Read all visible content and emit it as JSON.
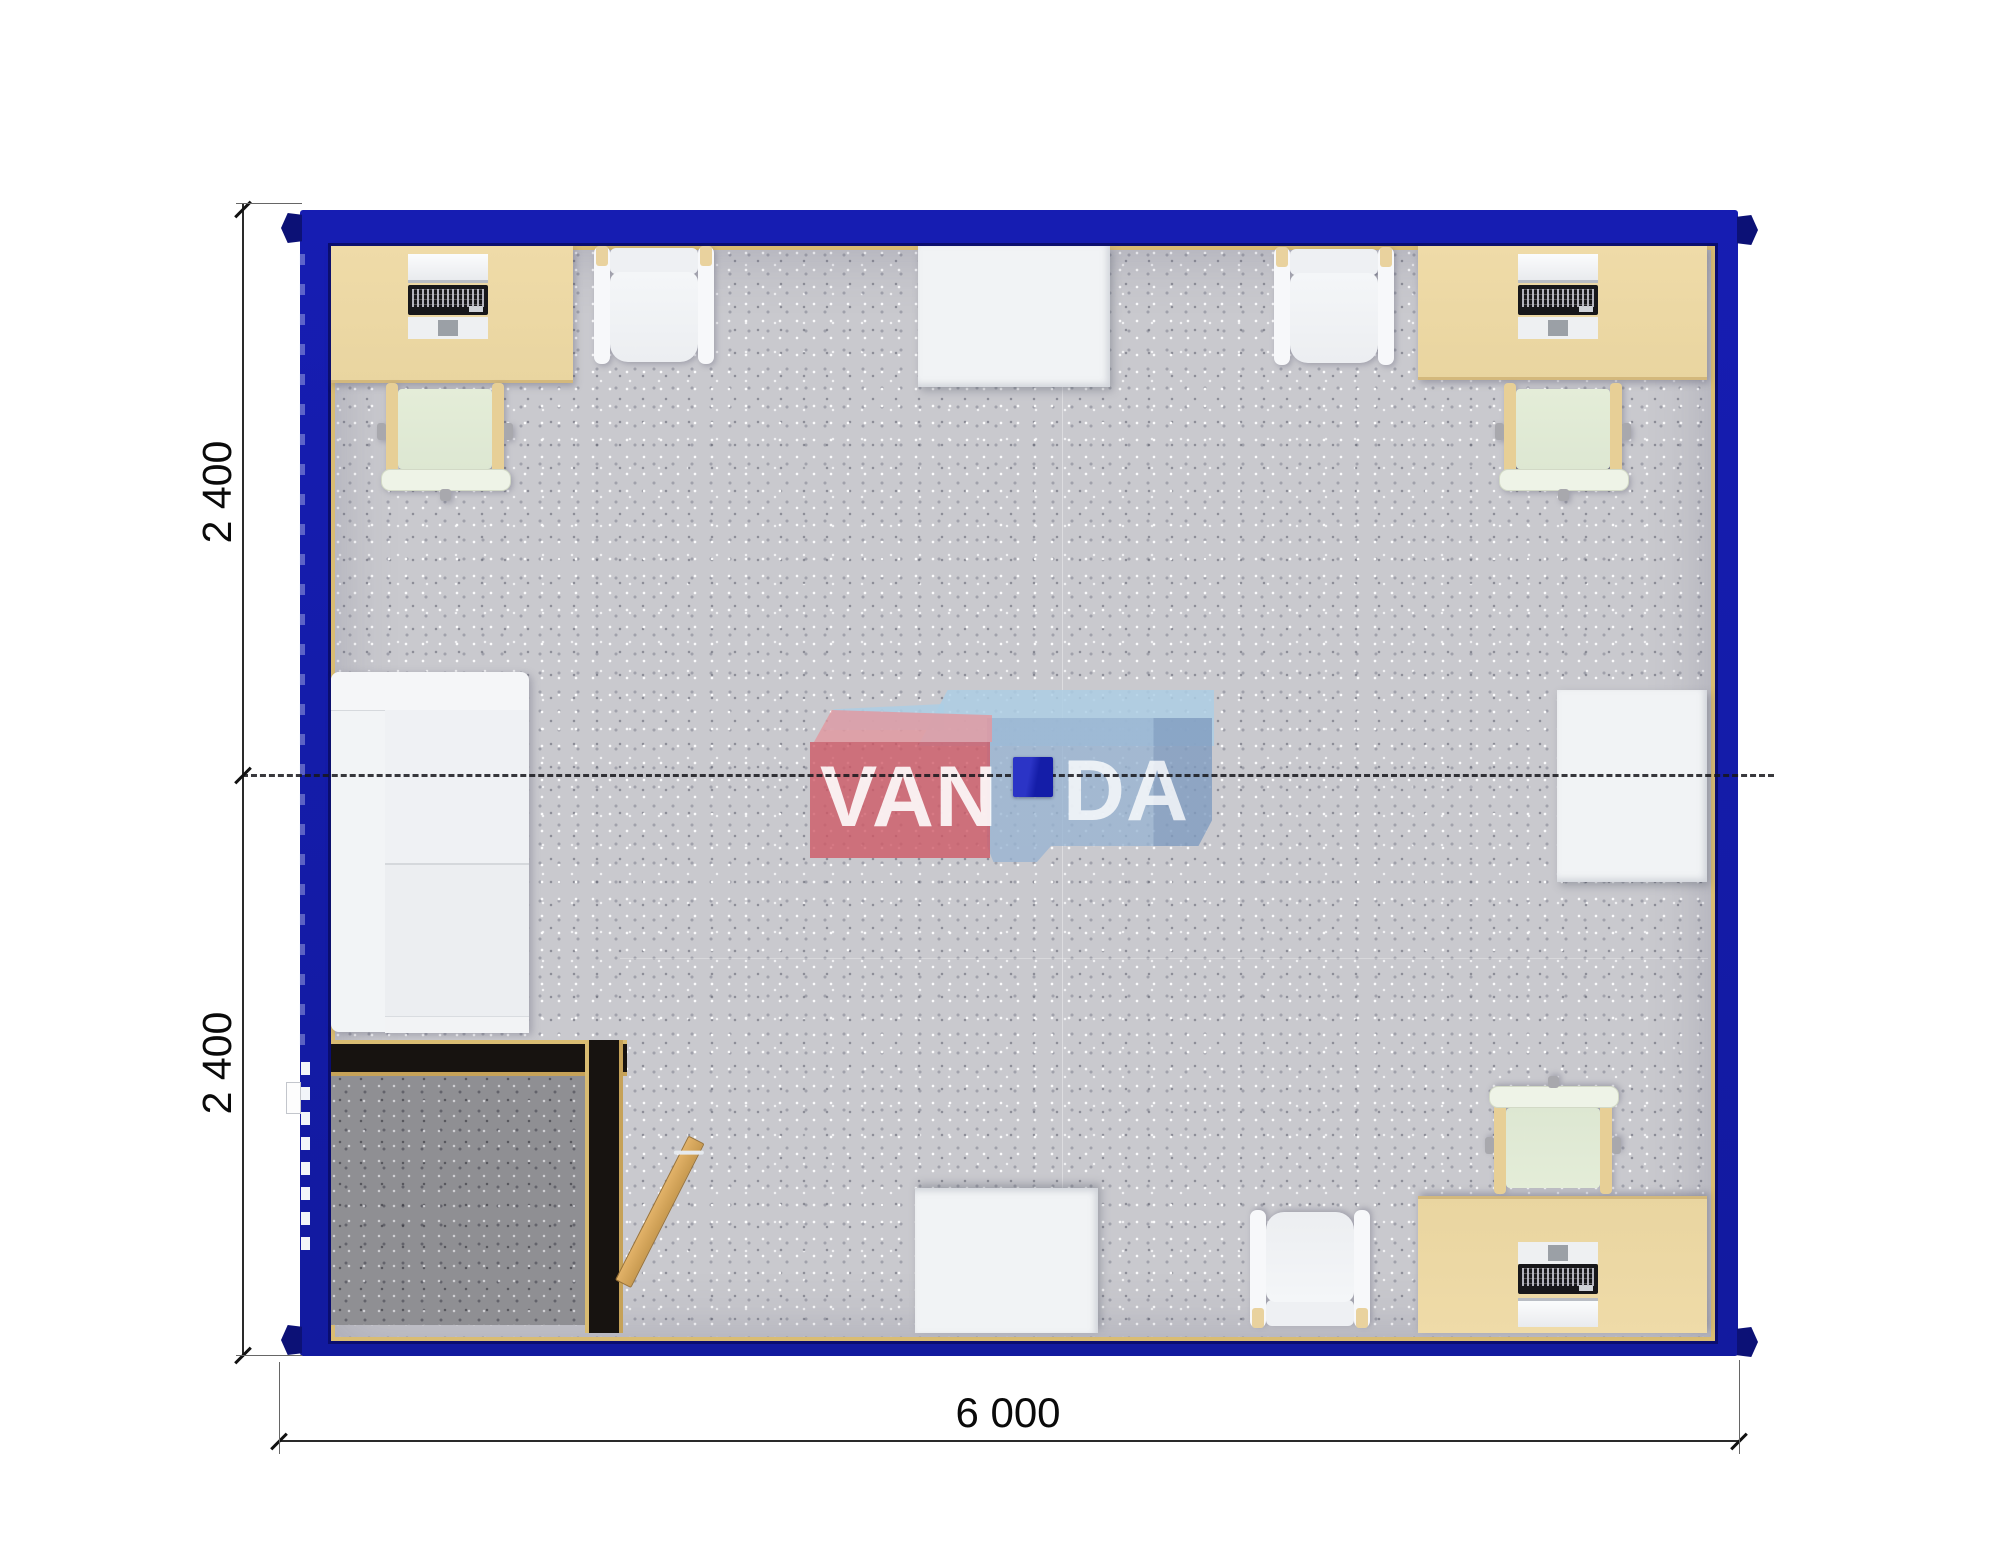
{
  "plan_type": "modular-container-office-floor-plan",
  "watermark": {
    "left_text": "VAN",
    "right_text": "DA"
  },
  "dimensions": {
    "left_upper": "2 400",
    "left_lower": "2 400",
    "bottom": "6 000"
  },
  "furniture": {
    "desks_with_computers": 3,
    "office_chairs": 3,
    "visitor_chairs": 3,
    "wall_tables": 3,
    "sofas": 1,
    "entry_vestibules": 1,
    "doors": 1,
    "ceiling_lamps": 1
  },
  "colors": {
    "frame_blue": "#161db2",
    "frame_blue_dark": "#0c1176",
    "trim_gold": "#d9bc72",
    "trim_gold_dark": "#c6a258",
    "carpet": "#c9c9ce",
    "carpet_dark": "#8f8f93",
    "partition_black": "#171310",
    "desk_tan": "#e9d5a0",
    "chair_green": "#dde7d2",
    "furniture_white": "#f1f3f5",
    "door_wood": "#c89a50",
    "lamp_blue": "#141da8",
    "dim_line": "#2a2a2a",
    "logo_red": "rgba(206,90,102,0.8)",
    "logo_pink": "rgba(226,152,160,0.82)",
    "logo_blue": "rgba(152,180,210,0.78)",
    "logo_blue_light": "rgba(173,206,228,0.85)"
  }
}
